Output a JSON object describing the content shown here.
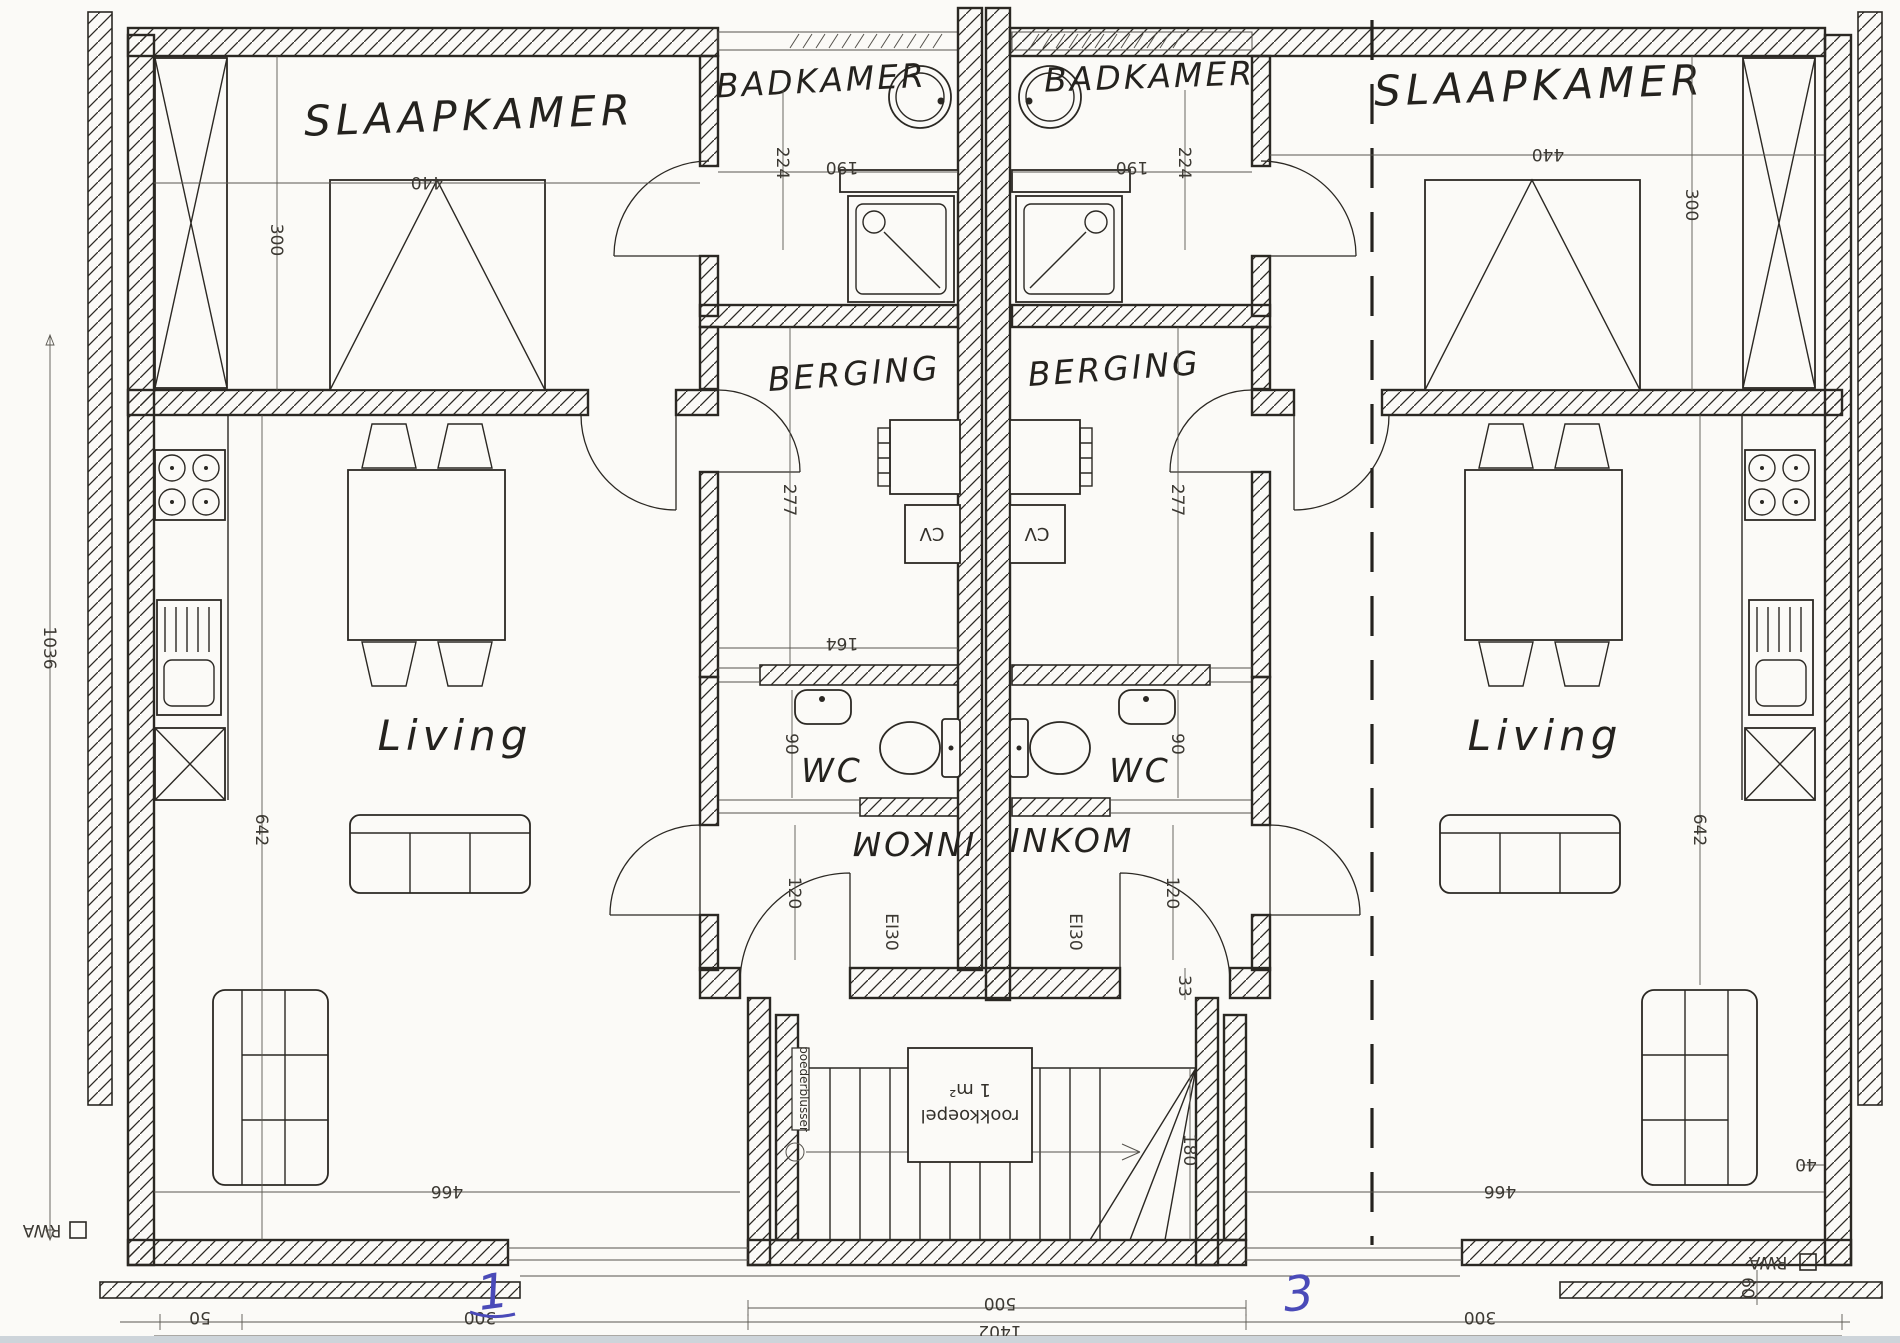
{
  "document": {
    "type": "floor-plan-scan",
    "language": "Dutch"
  },
  "colors": {
    "ink": "#2b2823",
    "paper": "#fbfaf7",
    "unit_number_blue": "#4a4ab8",
    "scan_edge": "#cdd4da"
  },
  "units": {
    "left_number": "1",
    "right_number": "3"
  },
  "labels": {
    "slaapkamer_left": "SLAAPKAMER",
    "slaapkamer_right": "SLAAPKAMER",
    "badkamer_left": "BADKAMER",
    "badkamer_right": "BADKAMER",
    "berging_left": "BERGING",
    "berging_right": "BERGING",
    "living_left": "Living",
    "living_right": "Living",
    "wc_left": "WC",
    "wc_right": "WC",
    "inkom_left": "INKOM",
    "inkom_right": "INKOM",
    "cv_left": "CV",
    "cv_right": "CV",
    "fire_door_left": "EI30",
    "fire_door_right": "EI30",
    "rookkoepel": "rookkoepel",
    "rookkoepel_area": "1 m²",
    "poederblusser": "poederblusser",
    "rwa_left": "RWA",
    "rwa_right": "RWA"
  },
  "dims": {
    "slaapkamer_width_left": "440",
    "slaapkamer_width_right": "440",
    "slaapkamer_depth_left": "300",
    "slaapkamer_depth_right": "300",
    "badkamer_depth_left": "224",
    "badkamer_depth_right": "224",
    "badkamer_width_left": "190",
    "badkamer_width_right": "190",
    "berging_depth_left": "277",
    "berging_depth_right": "277",
    "berging_width_left": "164",
    "wc_width_left": "90",
    "wc_width_right": "90",
    "inkom_width_left": "120",
    "inkom_width_right": "120",
    "wall_offset_right": "33",
    "stair_width": "180",
    "living_depth_left": "642",
    "living_depth_right": "642",
    "living_width_left": "466",
    "living_width_right": "466",
    "total_depth_left": "1036",
    "facade_small_left": "50",
    "facade_left": "300",
    "facade_right": "300",
    "hall_width": "500",
    "total_width": "1402",
    "corner_right": "40",
    "rwa_offset_right": "60"
  }
}
